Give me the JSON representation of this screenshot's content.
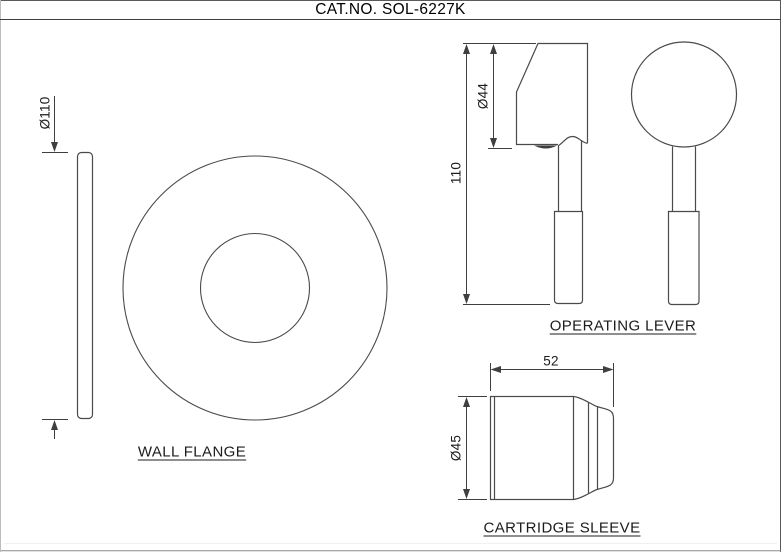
{
  "title": "CAT.NO. SOL-6227K",
  "views": {
    "wall_flange": {
      "label": "WALL FLANGE",
      "dims": {
        "outer_diameter": "Ø110"
      }
    },
    "operating_lever": {
      "label": "OPERATING LEVER",
      "dims": {
        "overall_length": "110",
        "head_diameter": "Ø44"
      }
    },
    "cartridge_sleeve": {
      "label": "CARTRIDGE SLEEVE",
      "dims": {
        "length": "52",
        "diameter": "Ø45"
      }
    }
  },
  "colors": {
    "line": "#3f3f3f",
    "background": "#ffffff",
    "border_dark": "#5a5a5a",
    "border_bottom": "#8c8c8c"
  }
}
